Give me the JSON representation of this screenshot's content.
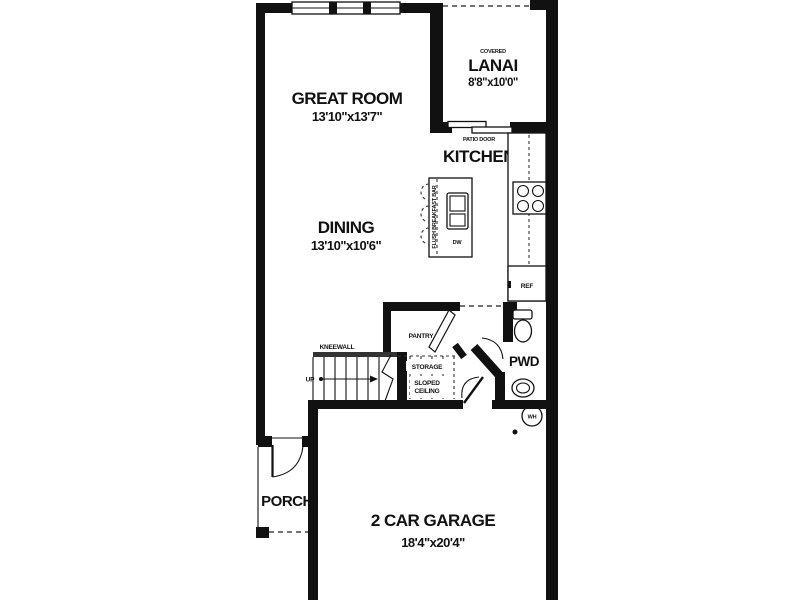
{
  "plan": {
    "title": "first-floor-plan",
    "colors": {
      "wall": "#111111",
      "background": "#ffffff",
      "line": "#222222"
    },
    "rooms": {
      "great_room": {
        "label": "GREAT ROOM",
        "dims": "13'10\"x13'7\""
      },
      "dining": {
        "label": "DINING",
        "dims": "13'10\"x10'6\""
      },
      "lanai": {
        "prefix": "COVERED",
        "label": "LANAI",
        "dims": "8'8\"x10'0\""
      },
      "kitchen": {
        "label": "KITCHEN"
      },
      "pantry": {
        "label": "PANTRY"
      },
      "powder": {
        "label": "PWD"
      },
      "porch": {
        "label": "PORCH"
      },
      "garage": {
        "label": "2 CAR GARAGE",
        "dims": "18'4\"x20'4\""
      }
    },
    "labels": {
      "patio_door": "PATIO DOOR",
      "kneewall": "KNEEWALL",
      "up": "UP",
      "storage": "STORAGE",
      "sloped": "SLOPED",
      "ceiling": "CEILING",
      "breakfast_bar": "FLUSH BREAKFAST BAR",
      "dishwasher": "DW",
      "refrigerator": "REF",
      "water_heater": "WH"
    }
  }
}
